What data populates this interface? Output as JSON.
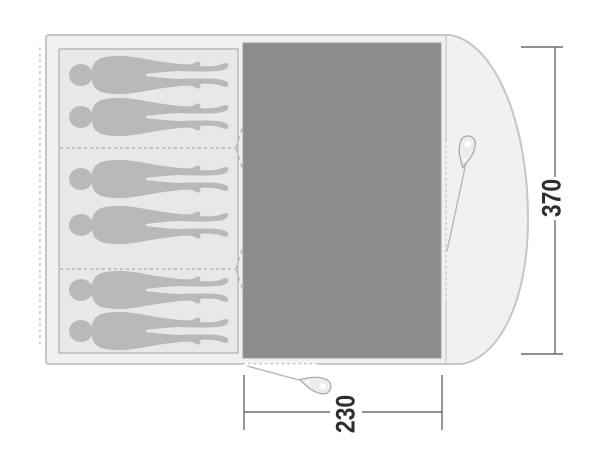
{
  "diagram": {
    "title": "tent-floorplan",
    "dimensions": {
      "width_label": "370",
      "depth_label": "230"
    },
    "sleeping": {
      "capacity": 6,
      "compartments": 3,
      "persons_per_compartment": 2
    },
    "icons": [
      "person-silhouette",
      "tent-peg-icon",
      "guy-rope",
      "dimension-arrow"
    ],
    "colors": {
      "canvas": "#ffffff",
      "tent_fill": "#f1f1f2",
      "tent_stroke": "#c5c6c8",
      "sleeping_fill": "#e8e8e9",
      "sleeping_stroke": "#b5b7b9",
      "person_fill": "#b7b9bb",
      "living_fill": "#8a8d8b",
      "divider": "#a9abad",
      "door_dash": "#b3b5b7",
      "inner_edge": "#cfd0d2",
      "rope": "#b4b6b8",
      "peg_fill": "#ececec",
      "peg_stroke": "#a8aaac",
      "dim_line": "#6b6b6d",
      "dim_text": "#2e2e30"
    }
  }
}
